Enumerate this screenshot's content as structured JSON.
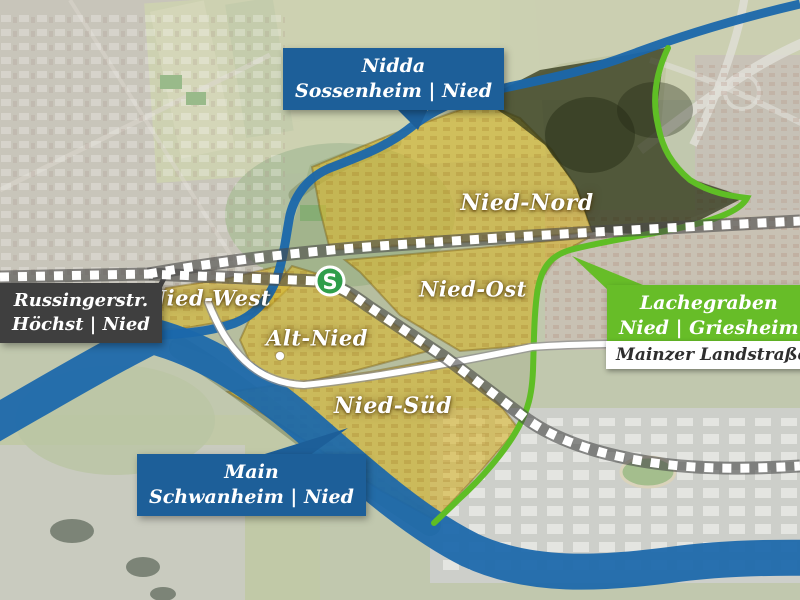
{
  "map": {
    "district_labels": [
      {
        "label": "Nied-Nord"
      },
      {
        "label": "Nied-Ost"
      },
      {
        "label": "Nied-West"
      },
      {
        "label": "Alt-Nied"
      },
      {
        "label": "Nied-Süd"
      }
    ],
    "callouts": {
      "nidda": {
        "line1": "Nidda",
        "line2": "Sossenheim | Nied"
      },
      "russingerstr": {
        "line1": "Russingerstr.",
        "line2": "Höchst | Nied"
      },
      "lachegraben": {
        "line1": "Lachegraben",
        "line2": "Nied | Griesheim"
      },
      "main": {
        "line1": "Main",
        "line2": "Schwanheim | Nied"
      },
      "mainzer_landstrasse": {
        "label": "Mainzer Landstraße"
      }
    },
    "station": {
      "label": "S"
    },
    "colors": {
      "river_blue": "#1a67ab",
      "callout_blue": "#1d5f99",
      "callout_dark": "#3f3f3f",
      "callout_green": "#67bd28",
      "boundary_green": "#5fbe25",
      "district_yellow": "#d9b832",
      "forest_dark": "#2a3114",
      "sbahn_green": "#2f9e4a"
    }
  }
}
